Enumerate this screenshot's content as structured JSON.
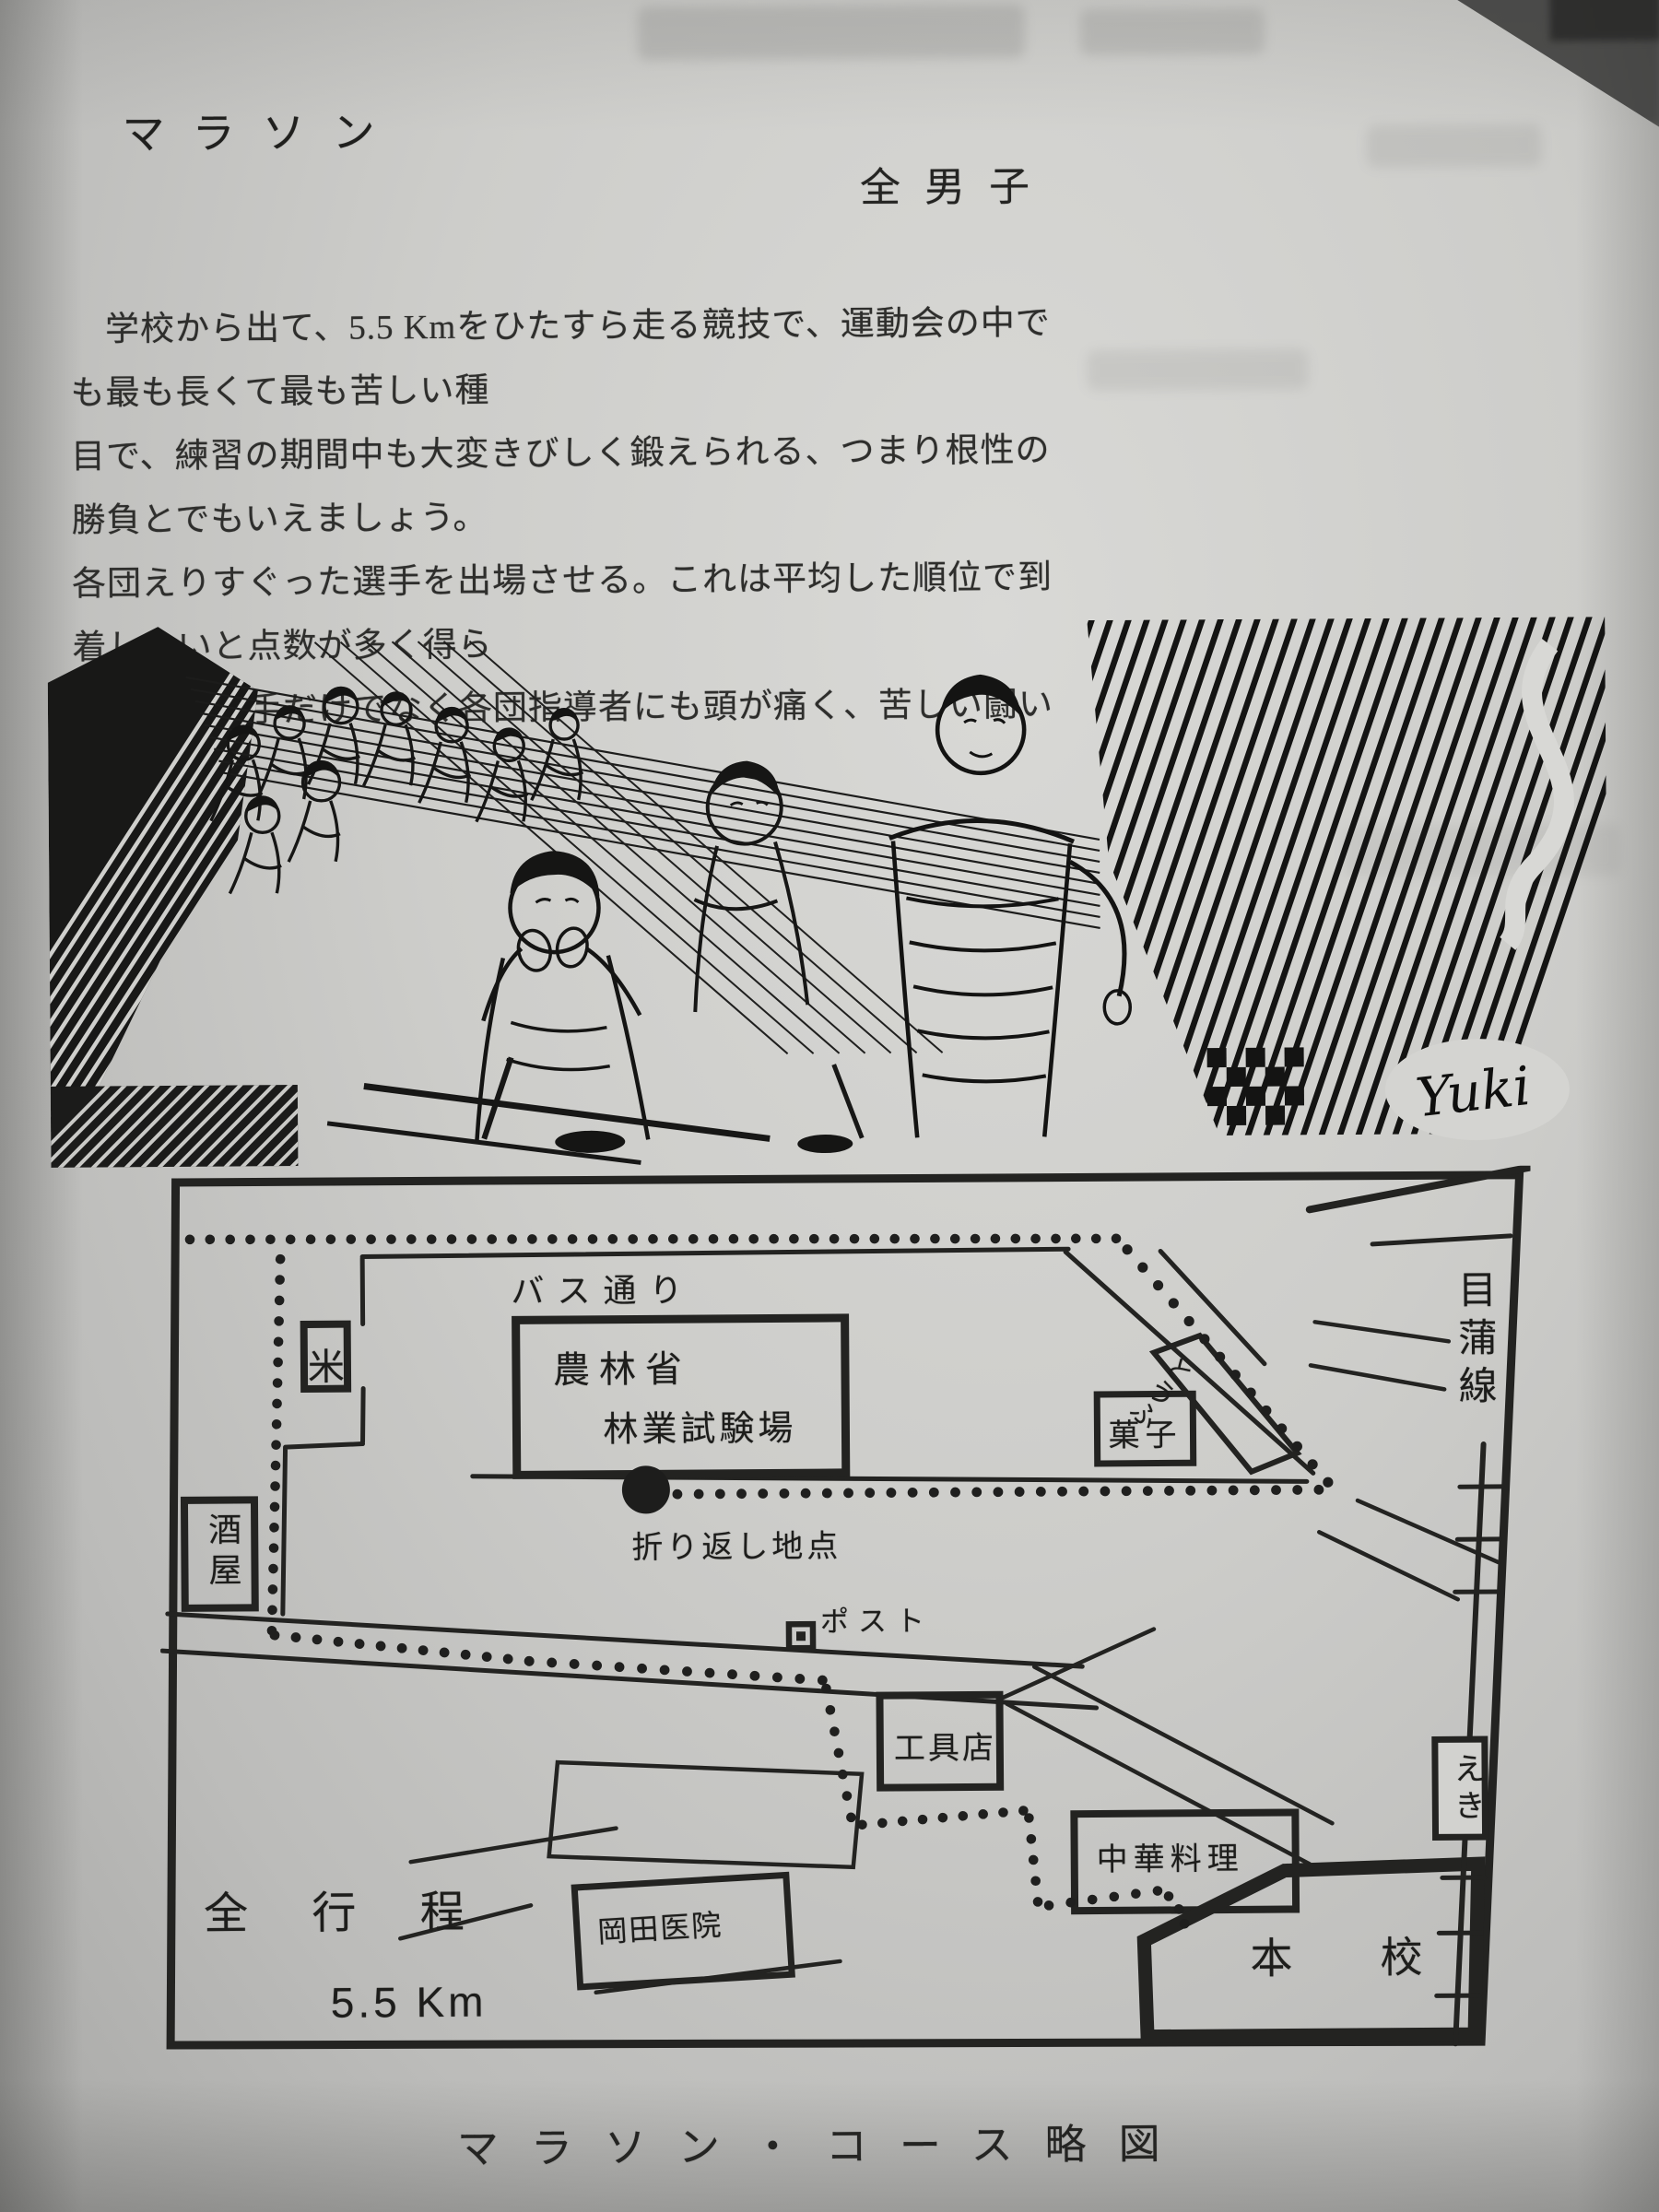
{
  "page": {
    "title": "マラソン",
    "byline": "全男子",
    "paragraph_lines": [
      "学校から出て、5.5 Kmをひたすら走る競技で、運動会の中でも最も長くて最も苦しい種",
      "目で、練習の期間中も大変きびしく鍛えられる、つまり根性の勝負とでもいえましょう。",
      "各団えりすぐった選手を出場させる。これは平均した順位で到着しないと点数が多く得ら",
      "れない、選手だけでなく各団指導者にも頭が痛く、苦しい闘いです。"
    ],
    "caption": "マラソン・コース略図"
  },
  "illustration": {
    "signature": "Yuki"
  },
  "map": {
    "labels": {
      "bus_street": "バス通り",
      "rice_shop": "米",
      "forestry_line1": "農林省",
      "forestry_line2": "林業試験場",
      "sweets_shop": "菓子",
      "tofu_shop": "とうふ",
      "mekama_line": "目蒲線",
      "sake_shop": "酒屋",
      "turnaround_point": "折り返し地点",
      "post_box": "ポスト",
      "tool_shop": "工具店",
      "chinese_restaurant": "中華料理",
      "okada_clinic": "岡田医院",
      "main_school": "本校",
      "station": "えき",
      "total_distance_label": "全 行 程",
      "total_distance_value": "5.5 Km"
    }
  }
}
